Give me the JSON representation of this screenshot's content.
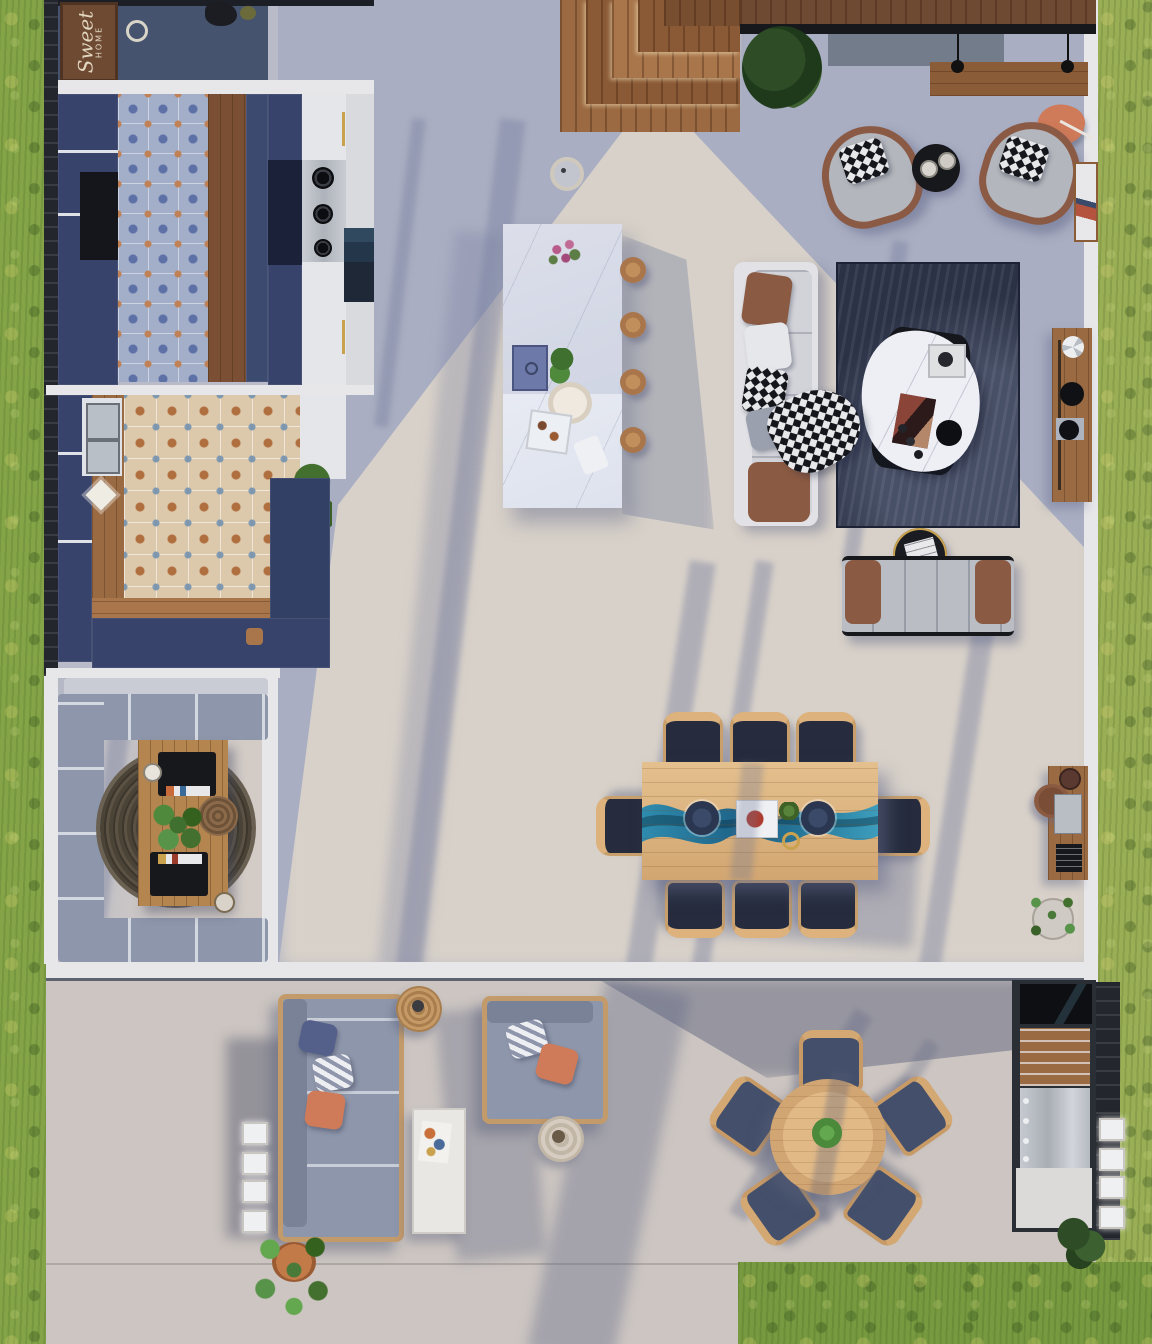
{
  "scene": {
    "type": "aerial-top-down-architectural-render",
    "doormat": {
      "line1": "Sweet",
      "line2": "HOME"
    },
    "areas": [
      "entry",
      "kitchen",
      "pantry-kitchen",
      "kitchen-island",
      "living-room",
      "dining-area",
      "home-office",
      "work-nook",
      "patio-lounge",
      "patio-dining",
      "outdoor-kitchen",
      "garden-lawn",
      "wood-deck"
    ],
    "furniture_counts": {
      "island_stools": 4,
      "dining_chairs": 8,
      "patio_dining_chairs": 5,
      "armchairs": 2,
      "laptops": 2,
      "wall_lights_left": 4,
      "wall_lights_right": 4
    }
  },
  "palette": {
    "grass": "#84a447",
    "grass-warm": "#9aae55",
    "fence": "#23262c",
    "wall": "#e7e7ea",
    "shade-floor": "#a9aec2",
    "sun-floor": "#d8d1c9",
    "patio-floor": "#ccc5c1",
    "navy": "#37436a",
    "navy-deep": "#1d2540",
    "black": "#14161b",
    "wood": "#9a6a42",
    "deck": "#a9764c",
    "wood-light": "#d9b184",
    "epoxy": "#2a7fa0",
    "marble-white": "#edeff4",
    "rug-navy": "#2b3246",
    "rug-round": "#4a4336",
    "sofa-white": "#e2e2e6",
    "sofa-gray": "#8e96ab",
    "leather": "#8a5a42",
    "coral": "#cf7a58",
    "tile-blue": "#a3aec8",
    "tile-orange": "#dcc8ab",
    "plant": "#4a7a3a"
  }
}
